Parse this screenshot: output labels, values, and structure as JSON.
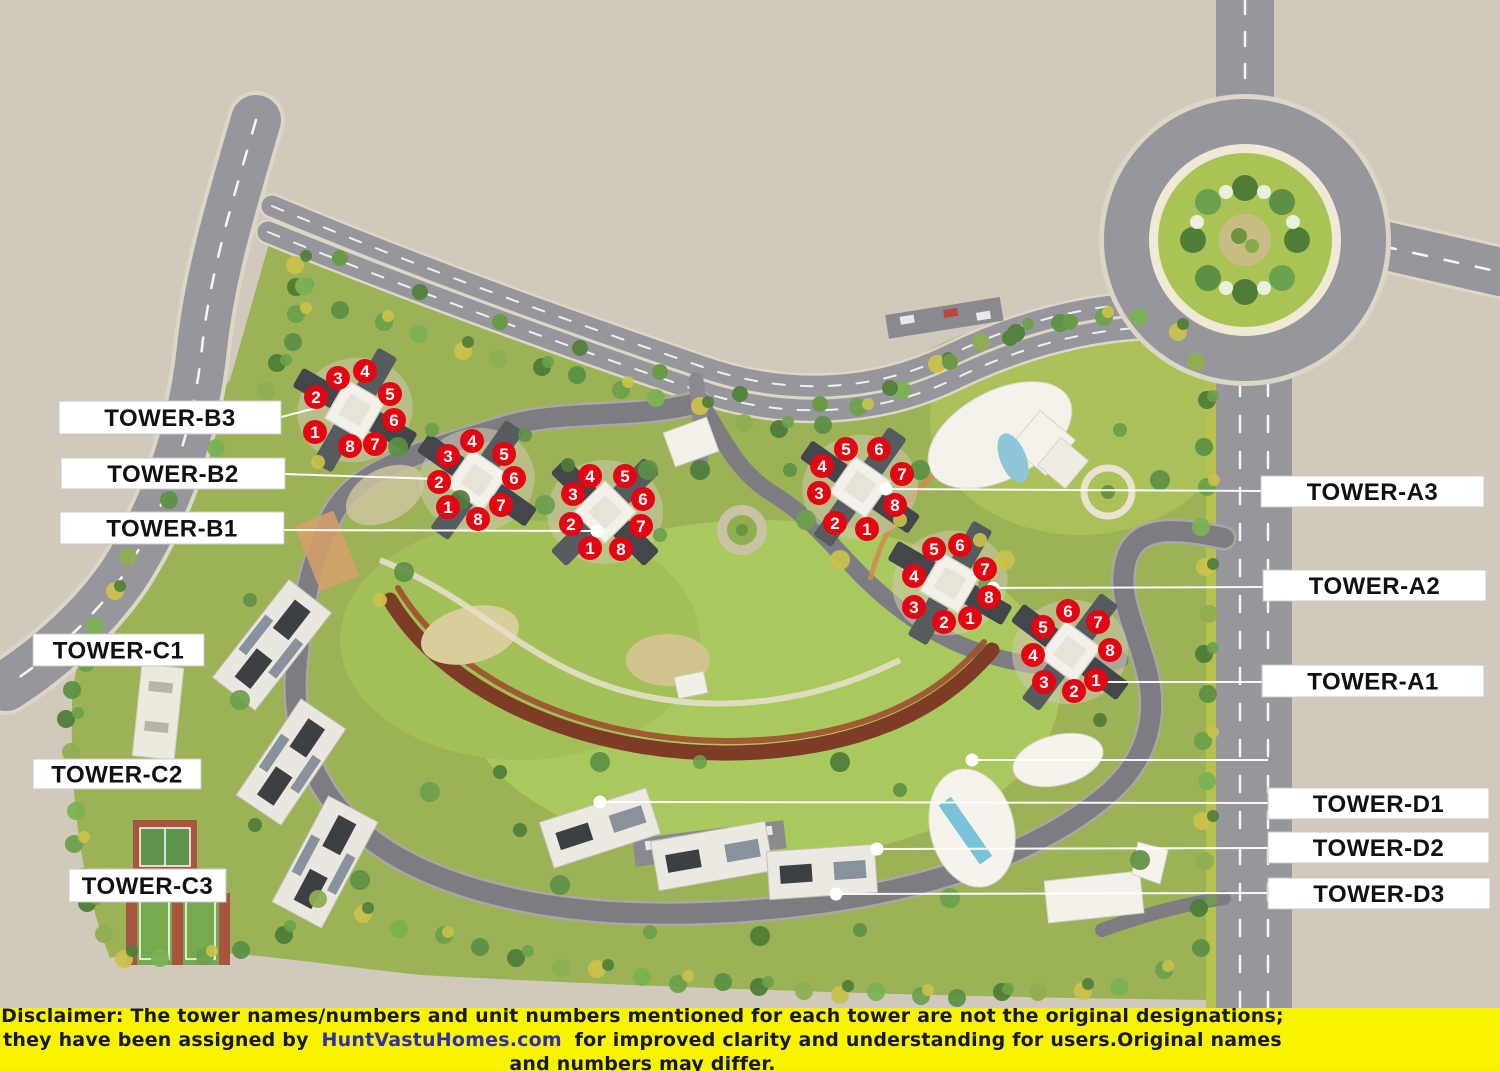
{
  "colors": {
    "background": "#d1cabc",
    "marker_red": "#e30613",
    "marker_number": "#ffffff",
    "label_bg": "#ffffff",
    "label_text": "#111111",
    "leader_line": "#ffffff",
    "disclaimer_bg": "#f8f400",
    "disclaimer_text": "#17173a",
    "disclaimer_link": "#2f2fae"
  },
  "towers": [
    {
      "id": "B3",
      "label": "TOWER-B3",
      "label_box": {
        "x": 59,
        "y": 401,
        "w": 222,
        "h": 33
      },
      "leader": [
        [
          281,
          417
        ],
        [
          316,
          408
        ]
      ],
      "dot": null,
      "markers": [
        {
          "n": "1",
          "x": 315,
          "y": 432
        },
        {
          "n": "2",
          "x": 316,
          "y": 397
        },
        {
          "n": "3",
          "x": 338,
          "y": 378
        },
        {
          "n": "4",
          "x": 365,
          "y": 371
        },
        {
          "n": "5",
          "x": 390,
          "y": 394
        },
        {
          "n": "6",
          "x": 394,
          "y": 420
        },
        {
          "n": "7",
          "x": 375,
          "y": 444
        },
        {
          "n": "8",
          "x": 350,
          "y": 446
        }
      ]
    },
    {
      "id": "B2",
      "label": "TOWER-B2",
      "label_box": {
        "x": 61,
        "y": 458,
        "w": 224,
        "h": 31
      },
      "leader": [
        [
          285,
          474
        ],
        [
          436,
          479
        ]
      ],
      "dot": null,
      "markers": [
        {
          "n": "1",
          "x": 448,
          "y": 507
        },
        {
          "n": "2",
          "x": 439,
          "y": 482
        },
        {
          "n": "3",
          "x": 448,
          "y": 456
        },
        {
          "n": "4",
          "x": 472,
          "y": 441
        },
        {
          "n": "5",
          "x": 504,
          "y": 454
        },
        {
          "n": "6",
          "x": 514,
          "y": 478
        },
        {
          "n": "7",
          "x": 501,
          "y": 505
        },
        {
          "n": "8",
          "x": 478,
          "y": 519
        }
      ]
    },
    {
      "id": "B1",
      "label": "TOWER-B1",
      "label_box": {
        "x": 60,
        "y": 512,
        "w": 224,
        "h": 32
      },
      "leader": [
        [
          284,
          530
        ],
        [
          596,
          531
        ]
      ],
      "dot": [
        597,
        531
      ],
      "markers": [
        {
          "n": "1",
          "x": 590,
          "y": 548
        },
        {
          "n": "2",
          "x": 571,
          "y": 524
        },
        {
          "n": "3",
          "x": 573,
          "y": 494
        },
        {
          "n": "4",
          "x": 590,
          "y": 476
        },
        {
          "n": "5",
          "x": 625,
          "y": 476
        },
        {
          "n": "6",
          "x": 643,
          "y": 499
        },
        {
          "n": "7",
          "x": 641,
          "y": 526
        },
        {
          "n": "8",
          "x": 621,
          "y": 549
        }
      ]
    },
    {
      "id": "A3",
      "label": "TOWER-A3",
      "label_box": {
        "x": 1261,
        "y": 476,
        "w": 223,
        "h": 31
      },
      "leader": [
        [
          1261,
          491
        ],
        [
          886,
          489
        ]
      ],
      "dot": [
        886,
        489
      ],
      "markers": [
        {
          "n": "1",
          "x": 867,
          "y": 529
        },
        {
          "n": "2",
          "x": 835,
          "y": 523
        },
        {
          "n": "3",
          "x": 819,
          "y": 493
        },
        {
          "n": "4",
          "x": 822,
          "y": 466
        },
        {
          "n": "5",
          "x": 846,
          "y": 449
        },
        {
          "n": "6",
          "x": 879,
          "y": 449
        },
        {
          "n": "7",
          "x": 902,
          "y": 474
        },
        {
          "n": "8",
          "x": 895,
          "y": 505
        }
      ]
    },
    {
      "id": "A2",
      "label": "TOWER-A2",
      "label_box": {
        "x": 1263,
        "y": 570,
        "w": 223,
        "h": 31
      },
      "leader": [
        [
          1263,
          587
        ],
        [
          993,
          588
        ]
      ],
      "dot": [
        993,
        588
      ],
      "markers": [
        {
          "n": "1",
          "x": 970,
          "y": 618
        },
        {
          "n": "2",
          "x": 944,
          "y": 622
        },
        {
          "n": "3",
          "x": 914,
          "y": 607
        },
        {
          "n": "4",
          "x": 914,
          "y": 576
        },
        {
          "n": "5",
          "x": 934,
          "y": 549
        },
        {
          "n": "6",
          "x": 960,
          "y": 545
        },
        {
          "n": "7",
          "x": 985,
          "y": 569
        },
        {
          "n": "8",
          "x": 989,
          "y": 597
        }
      ]
    },
    {
      "id": "A1",
      "label": "TOWER-A1",
      "label_box": {
        "x": 1262,
        "y": 665,
        "w": 222,
        "h": 32
      },
      "leader": [
        [
          1262,
          682
        ],
        [
          1097,
          682
        ]
      ],
      "dot": null,
      "markers": [
        {
          "n": "1",
          "x": 1096,
          "y": 680
        },
        {
          "n": "2",
          "x": 1074,
          "y": 691
        },
        {
          "n": "3",
          "x": 1044,
          "y": 682
        },
        {
          "n": "4",
          "x": 1033,
          "y": 655
        },
        {
          "n": "5",
          "x": 1043,
          "y": 627
        },
        {
          "n": "6",
          "x": 1068,
          "y": 611
        },
        {
          "n": "7",
          "x": 1098,
          "y": 622
        },
        {
          "n": "8",
          "x": 1110,
          "y": 650
        }
      ]
    },
    {
      "id": "C1",
      "label": "TOWER-C1",
      "label_box": {
        "x": 33,
        "y": 634,
        "w": 171,
        "h": 32
      },
      "leader": null,
      "dot": null,
      "markers": []
    },
    {
      "id": "C2",
      "label": "TOWER-C2",
      "label_box": {
        "x": 33,
        "y": 759,
        "w": 168,
        "h": 30
      },
      "leader": null,
      "dot": null,
      "markers": []
    },
    {
      "id": "C3",
      "label": "TOWER-C3",
      "label_box": {
        "x": 69,
        "y": 869,
        "w": 157,
        "h": 33
      },
      "leader": null,
      "dot": null,
      "markers": []
    },
    {
      "id": "D1",
      "label": "TOWER-D1",
      "label_box": {
        "x": 1268,
        "y": 788,
        "w": 221,
        "h": 31
      },
      "leader": [
        [
          1268,
          803
        ],
        [
          600,
          802
        ]
      ],
      "dot": [
        600,
        802
      ],
      "markers": []
    },
    {
      "id": "D2",
      "label": "TOWER-D2",
      "label_box": {
        "x": 1268,
        "y": 832,
        "w": 221,
        "h": 31
      },
      "leader": [
        [
          1268,
          848
        ],
        [
          877,
          849
        ]
      ],
      "dot": [
        877,
        849
      ],
      "markers": []
    },
    {
      "id": "D3",
      "label": "TOWER-D3",
      "label_box": {
        "x": 1268,
        "y": 878,
        "w": 222,
        "h": 31
      },
      "leader": [
        [
          1268,
          893
        ],
        [
          836,
          894
        ]
      ],
      "dot": [
        836,
        894
      ],
      "markers": []
    }
  ],
  "extra_leaders": [
    {
      "line": [
        [
          1268,
          760
        ],
        [
          972,
          760
        ]
      ],
      "dot": [
        972,
        760
      ]
    }
  ],
  "disclaimer": {
    "label": "Disclaimer:",
    "line1_rest": " The tower names/numbers and unit numbers mentioned for each tower are not the original designations;",
    "line2_before_link": "they have been assigned by ",
    "link": "HuntVastuHomes.com",
    "line2_after_link": " for improved clarity and understanding for users.Original names and numbers may differ."
  }
}
